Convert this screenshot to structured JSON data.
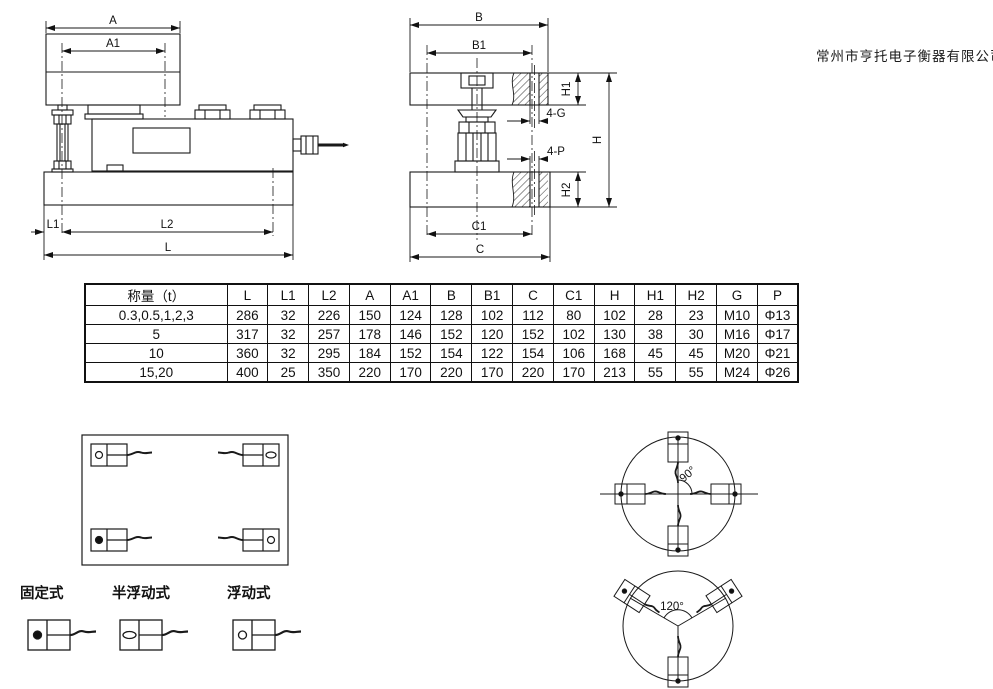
{
  "company_name": "常州市亨托电子衡器有限公司",
  "side_view": {
    "dims": {
      "a": "A",
      "a1": "A1",
      "l1": "L1",
      "l2": "L2",
      "l": "L"
    }
  },
  "end_view": {
    "dims": {
      "b": "B",
      "b1": "B1",
      "h1": "H1",
      "four_g": "4-G",
      "four_p": "4-P",
      "h": "H",
      "h2": "H2",
      "c1": "C1",
      "c": "C"
    }
  },
  "table": {
    "headers": [
      "称量（t）",
      "L",
      "L1",
      "L2",
      "A",
      "A1",
      "B",
      "B1",
      "C",
      "C1",
      "H",
      "H1",
      "H2",
      "G",
      "P"
    ],
    "rows": [
      [
        "0.3,0.5,1,2,3",
        "286",
        "32",
        "226",
        "150",
        "124",
        "128",
        "102",
        "112",
        "80",
        "102",
        "28",
        "23",
        "M10",
        "Φ13"
      ],
      [
        "5",
        "317",
        "32",
        "257",
        "178",
        "146",
        "152",
        "120",
        "152",
        "102",
        "130",
        "38",
        "30",
        "M16",
        "Φ17"
      ],
      [
        "10",
        "360",
        "32",
        "295",
        "184",
        "152",
        "154",
        "122",
        "154",
        "106",
        "168",
        "45",
        "45",
        "M20",
        "Φ21"
      ],
      [
        "15,20",
        "400",
        "25",
        "350",
        "220",
        "170",
        "220",
        "170",
        "220",
        "170",
        "213",
        "55",
        "55",
        "M24",
        "Φ26"
      ]
    ]
  },
  "mount_types": [
    {
      "label": "固定式",
      "marker": "filled-circle"
    },
    {
      "label": "半浮动式",
      "marker": "oval"
    },
    {
      "label": "浮动式",
      "marker": "open-circle"
    }
  ],
  "arrangements": {
    "quad_angle": "90°",
    "tri_angle": "120°"
  }
}
